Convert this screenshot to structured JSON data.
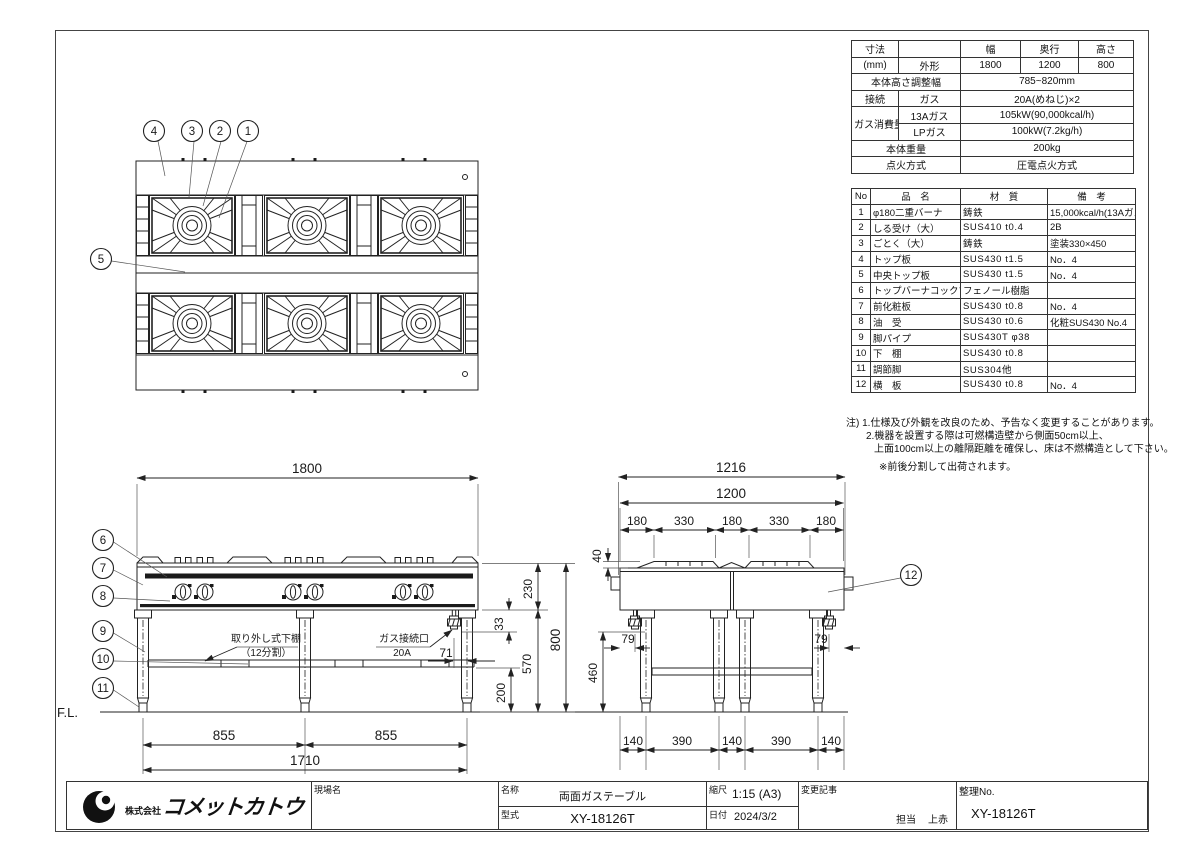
{
  "spec": {
    "h_label": "寸法",
    "h_blank": "",
    "h_w": "幅",
    "h_d": "奥行",
    "h_h": "高さ",
    "unit": "(mm)",
    "outer": "外形",
    "w": "1800",
    "d": "1200",
    "h": "800",
    "adj_label": "本体高さ調整幅",
    "adj_value": "785~820mm",
    "conn_label": "接続",
    "conn_sub": "ガス",
    "conn_value": "20A(めねじ)×2",
    "gas_label": "ガス消費量",
    "gas13": "13Aガス",
    "gas13_v": "105kW(90,000kcal/h)",
    "gaslp": "LPガス",
    "gaslp_v": "100kW(7.2kg/h)",
    "weight_label": "本体重量",
    "weight": "200kg",
    "ign_label": "点火方式",
    "ign": "圧電点火方式"
  },
  "parts": {
    "headers": [
      "No",
      "品　名",
      "材　質",
      "備　考"
    ],
    "rows": [
      [
        "1",
        "φ180二重バーナ",
        "鋳鉄",
        "15,000kcal/h(13Aガス)"
      ],
      [
        "2",
        "しる受け（大）",
        "SUS410 t0.4",
        "2B"
      ],
      [
        "3",
        "ごとく（大）",
        "鋳鉄",
        "塗装330×450"
      ],
      [
        "4",
        "トップ板",
        "SUS430 t1.5",
        "No．4"
      ],
      [
        "5",
        "中央トップ板",
        "SUS430 t1.5",
        "No．4"
      ],
      [
        "6",
        "トップバーナコックツマミ",
        "フェノール樹脂",
        ""
      ],
      [
        "7",
        "前化粧板",
        "SUS430 t0.8",
        "No．4"
      ],
      [
        "8",
        "油　受",
        "SUS430 t0.6",
        "化粧SUS430 No.4"
      ],
      [
        "9",
        "脚パイプ",
        "SUS430T φ38",
        ""
      ],
      [
        "10",
        "下　棚",
        "SUS430 t0.8",
        ""
      ],
      [
        "11",
        "調節脚",
        "SUS304他",
        ""
      ],
      [
        "12",
        "横　板",
        "SUS430 t0.8",
        "No．4"
      ]
    ]
  },
  "notes": {
    "line1": "注) 1.仕様及び外観を改良のため、予告なく変更することがあります。",
    "line2": "2.機器を設置する際は可燃構造壁から側面50cm以上、",
    "line3": "上面100cm以上の離隔距離を確保し、床は不燃構造として下さい。",
    "line4": "※前後分割して出荷されます。"
  },
  "balloons": [
    "1",
    "2",
    "3",
    "4",
    "5",
    "6",
    "7",
    "8",
    "9",
    "10",
    "11",
    "12"
  ],
  "labels": {
    "fl": "F.L.",
    "shelf": "取り外し式下棚",
    "shelf_sub": "（12分割）",
    "gas": "ガス接続口",
    "gas_size": "20A"
  },
  "dims": {
    "front": {
      "w1800": "1800",
      "h230": "230",
      "h800": "800",
      "h33": "33",
      "h570": "570",
      "h200": "200",
      "w71": "71",
      "s855a": "855",
      "s855b": "855",
      "w1710": "1710"
    },
    "side": {
      "w1216": "1216",
      "w1200": "1200",
      "a180": "180",
      "a330": "330",
      "b180": "180",
      "b330": "330",
      "c180": "180",
      "h40": "40",
      "p79l": "79",
      "p79r": "79",
      "h460": "460",
      "f140a": "140",
      "f390a": "390",
      "f140b": "140",
      "f390b": "390",
      "f140c": "140"
    }
  },
  "title_block": {
    "company_small": "株式会社",
    "company": "コメットカトウ",
    "site_label": "現場名",
    "name_label": "名称",
    "name_value": "両面ガステーブル",
    "model_label": "型式",
    "model_value": "XY-18126T",
    "scale_label": "縮尺",
    "scale_value": "1:15 (A3)",
    "date_label": "日付",
    "date_value": "2024/3/2",
    "change_label": "変更記事",
    "charge_label": "担当",
    "charge_value": "上赤",
    "no_label": "整理No.",
    "no_value": "XY-18126T"
  }
}
